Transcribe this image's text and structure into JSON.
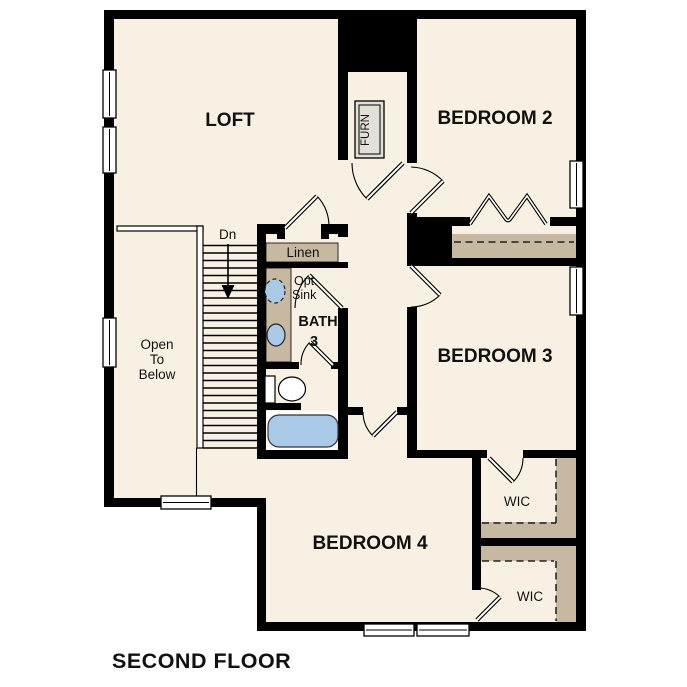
{
  "title": "SECOND FLOOR",
  "plan": {
    "rooms": {
      "loft": "LOFT",
      "bedroom2": "BEDROOM 2",
      "bedroom3": "BEDROOM 3",
      "bedroom4": "BEDROOM 4",
      "bath_line1": "BATH",
      "bath_line2": "3",
      "wic_top": "WIC",
      "wic_bottom": "WIC",
      "linen": "Linen",
      "furnace": "FURN"
    },
    "annotations": {
      "stairs_direction": "Dn",
      "open_to_below_line1": "Open",
      "open_to_below_line2": "To",
      "open_to_below_line3": "Below",
      "optional_sink_line1": "Opt.",
      "optional_sink_line2": "Sink"
    },
    "colors": {
      "wall": "#000000",
      "floor": "#f8f1e3",
      "shelf": "#c7b9a1",
      "fixture_blue": "#a9c9e7",
      "furnace_fill": "#e2dfd7",
      "background": "#ffffff"
    }
  }
}
